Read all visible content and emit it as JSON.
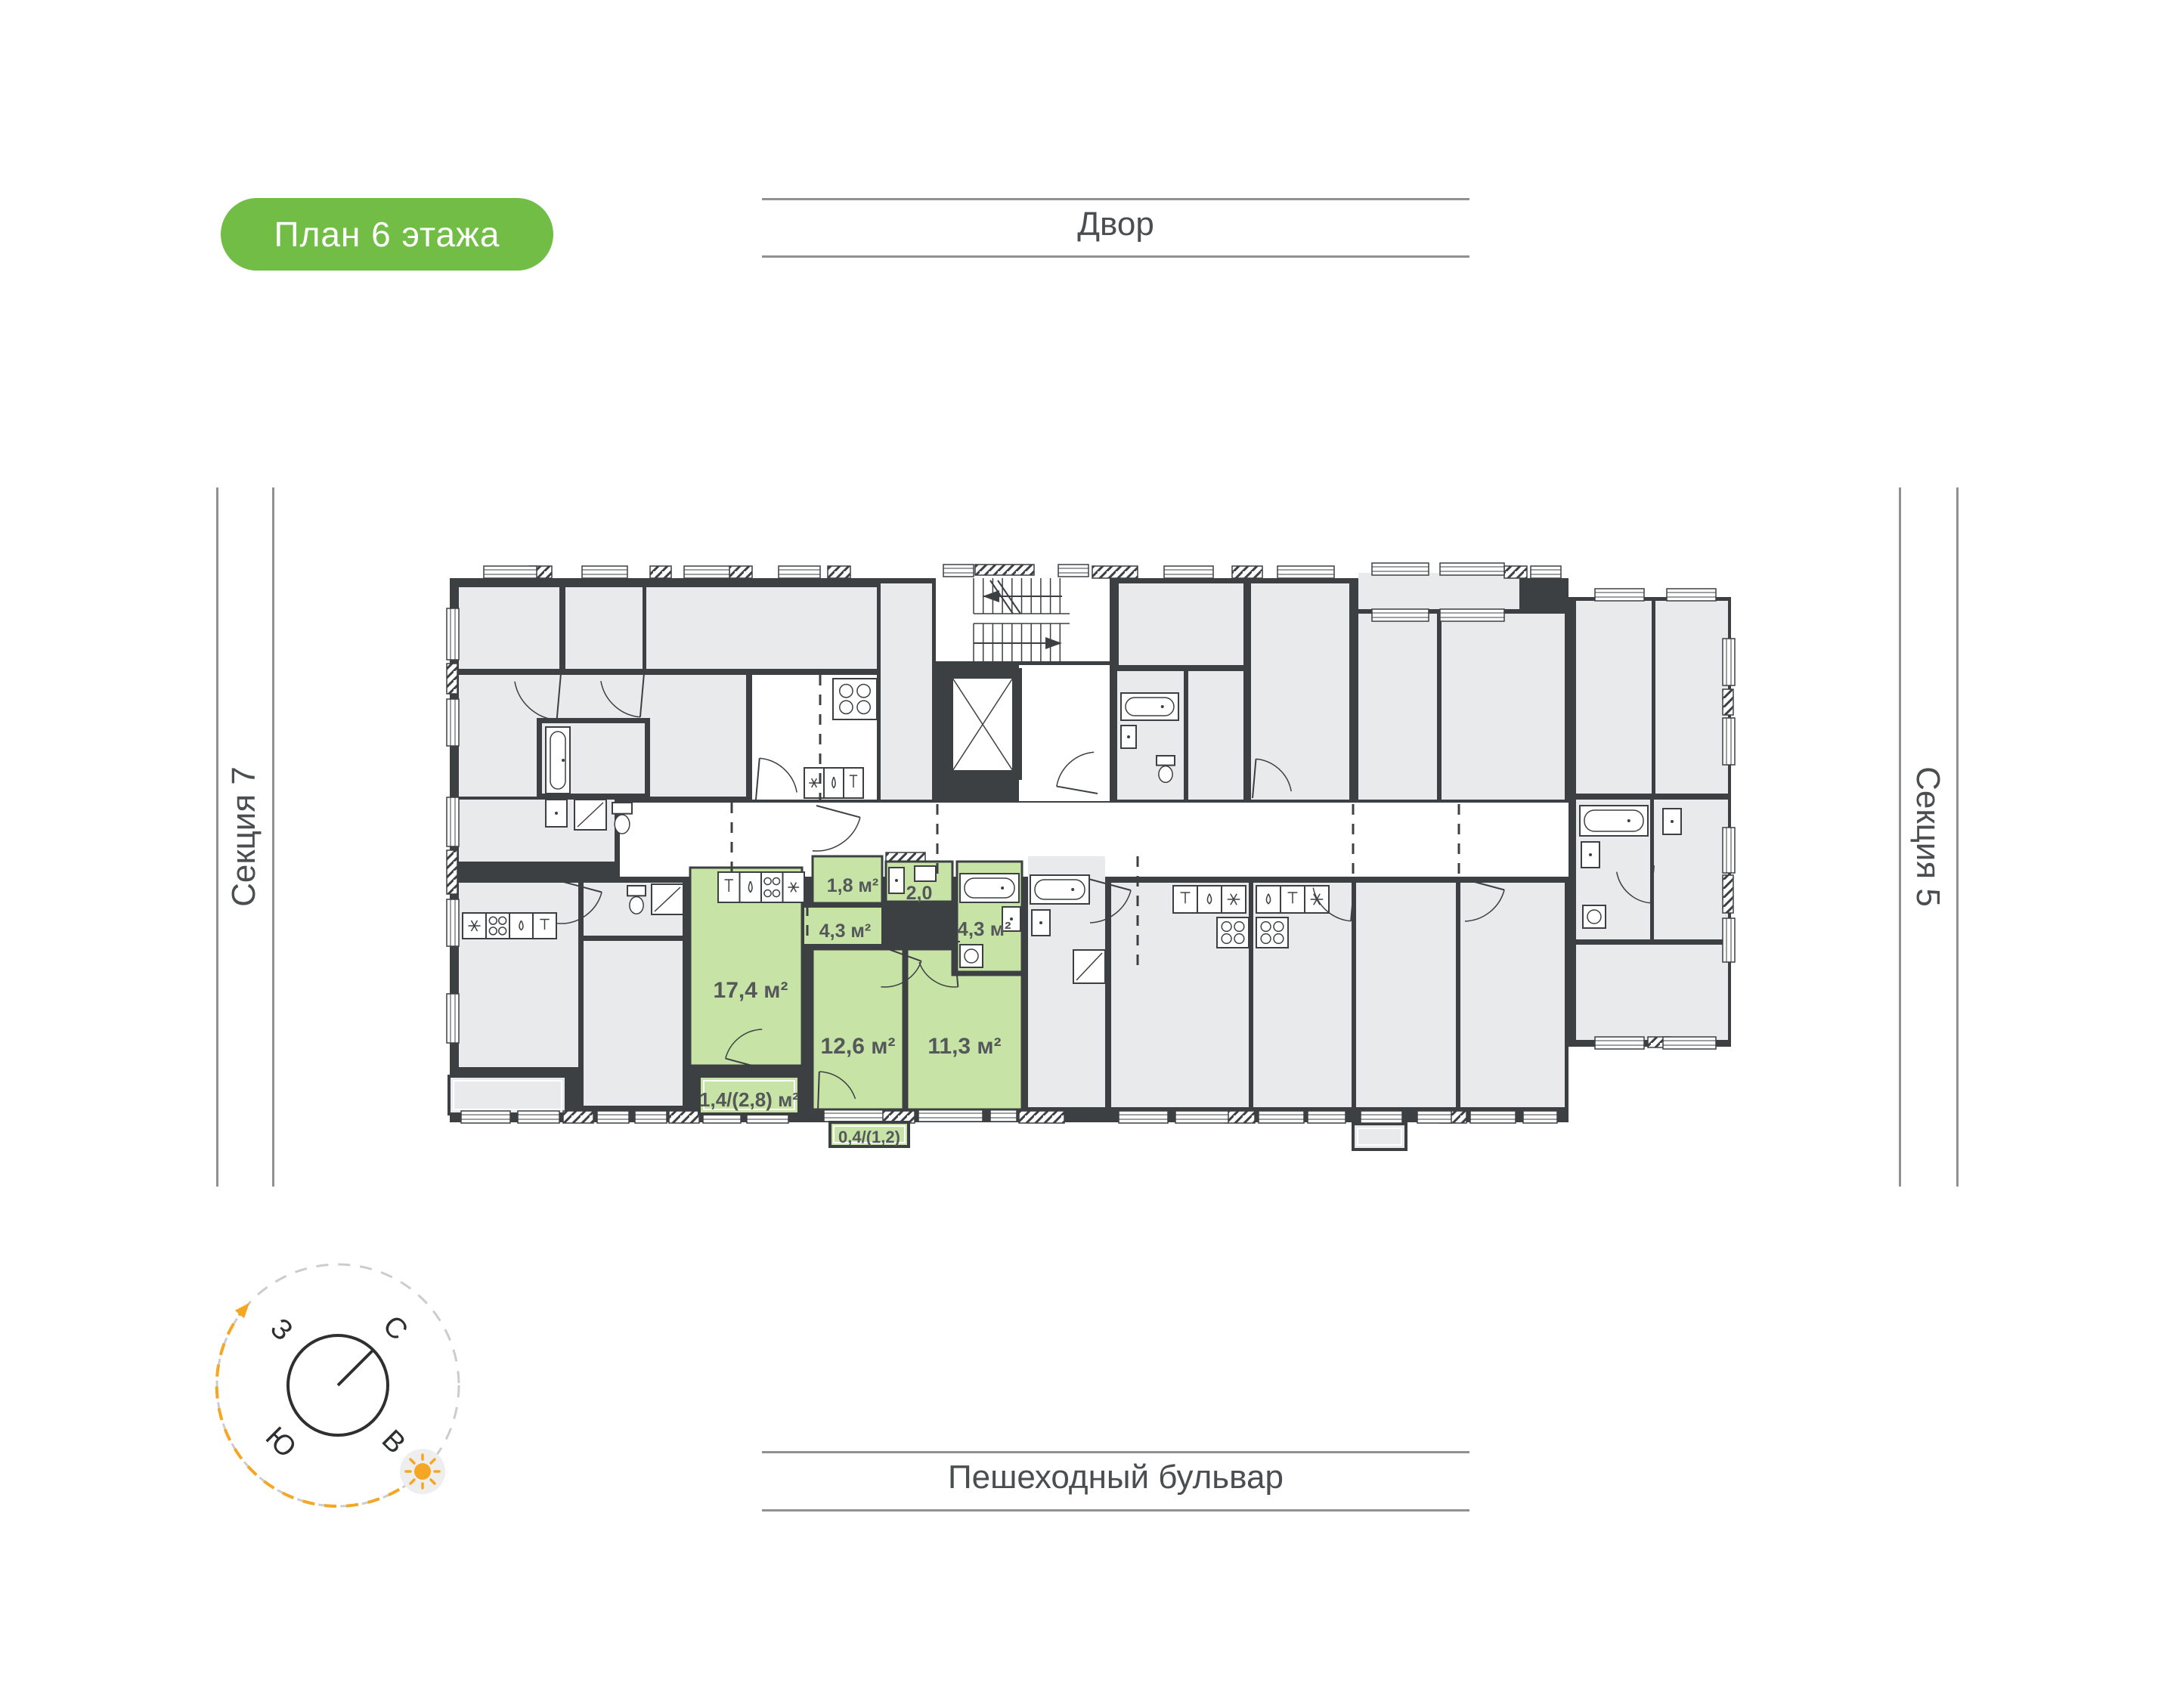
{
  "page": {
    "badge": "План 6 этажа",
    "courtyard_label": "Двор",
    "boulevard_label": "Пешеходный бульвар",
    "section_left": "Секция 7",
    "section_right": "Секция 5"
  },
  "plan": {
    "highlighted_apartment": {
      "rooms": [
        {
          "id": "kitchen-living",
          "area": "17,4 м²"
        },
        {
          "id": "hallway",
          "area": "1,8 м²"
        },
        {
          "id": "bathroom-small",
          "area": "2,0"
        },
        {
          "id": "corridor",
          "area": "4,3 м²"
        },
        {
          "id": "bathroom",
          "area": "4,3 м²"
        },
        {
          "id": "bedroom-1",
          "area": "12,6 м²"
        },
        {
          "id": "bedroom-2",
          "area": "11,3 м²"
        },
        {
          "id": "loggia",
          "area": "1,4/(2,8) м²"
        },
        {
          "id": "balcony",
          "area": "0,4/(1,2)"
        }
      ]
    }
  },
  "compass": {
    "north": "С",
    "east": "В",
    "south": "Ю",
    "west": "З"
  },
  "colors": {
    "accent_green": "#72bd46",
    "apartment_green": "#c7e3a5",
    "wall_dark": "#3d4043",
    "room_gray": "#e9eaeb",
    "rule_gray": "#8f9193",
    "sun_orange": "#f5a623"
  }
}
